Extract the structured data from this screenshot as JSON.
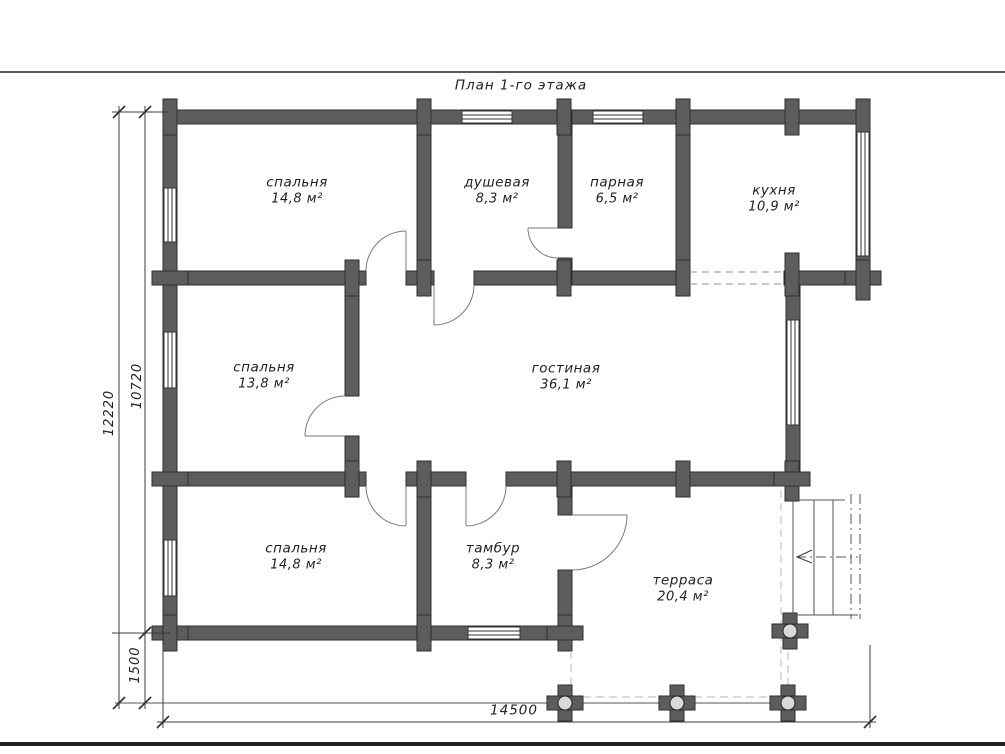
{
  "title": "План 1-го этажа",
  "rooms": [
    {
      "id": "bedroom-top",
      "name": "спальня",
      "area": "14,8 м²"
    },
    {
      "id": "shower",
      "name": "душевая",
      "area": "8,3 м²"
    },
    {
      "id": "steam-room",
      "name": "парная",
      "area": "6,5 м²"
    },
    {
      "id": "kitchen",
      "name": "кухня",
      "area": "10,9 м²"
    },
    {
      "id": "bedroom-middle",
      "name": "спальня",
      "area": "13,8 м²"
    },
    {
      "id": "living-room",
      "name": "гостиная",
      "area": "36,1 м²"
    },
    {
      "id": "bedroom-bottom",
      "name": "спальня",
      "area": "14,8 м²"
    },
    {
      "id": "vestibule",
      "name": "тамбур",
      "area": "8,3 м²"
    },
    {
      "id": "terrace",
      "name": "терраса",
      "area": "20,4 м²"
    }
  ],
  "dimensions": {
    "overall_height": "12220",
    "house_height": "10720",
    "terrace_offset": "1500",
    "overall_width": "14500"
  },
  "colors": {
    "wall_fill": "#5d5d5d",
    "wall_outline": "#2e2e2e",
    "thin_line": "#3c3c3c",
    "dashed_line": "#bdbdbd",
    "text": "#1f1f1f",
    "background": "#ffffff"
  }
}
